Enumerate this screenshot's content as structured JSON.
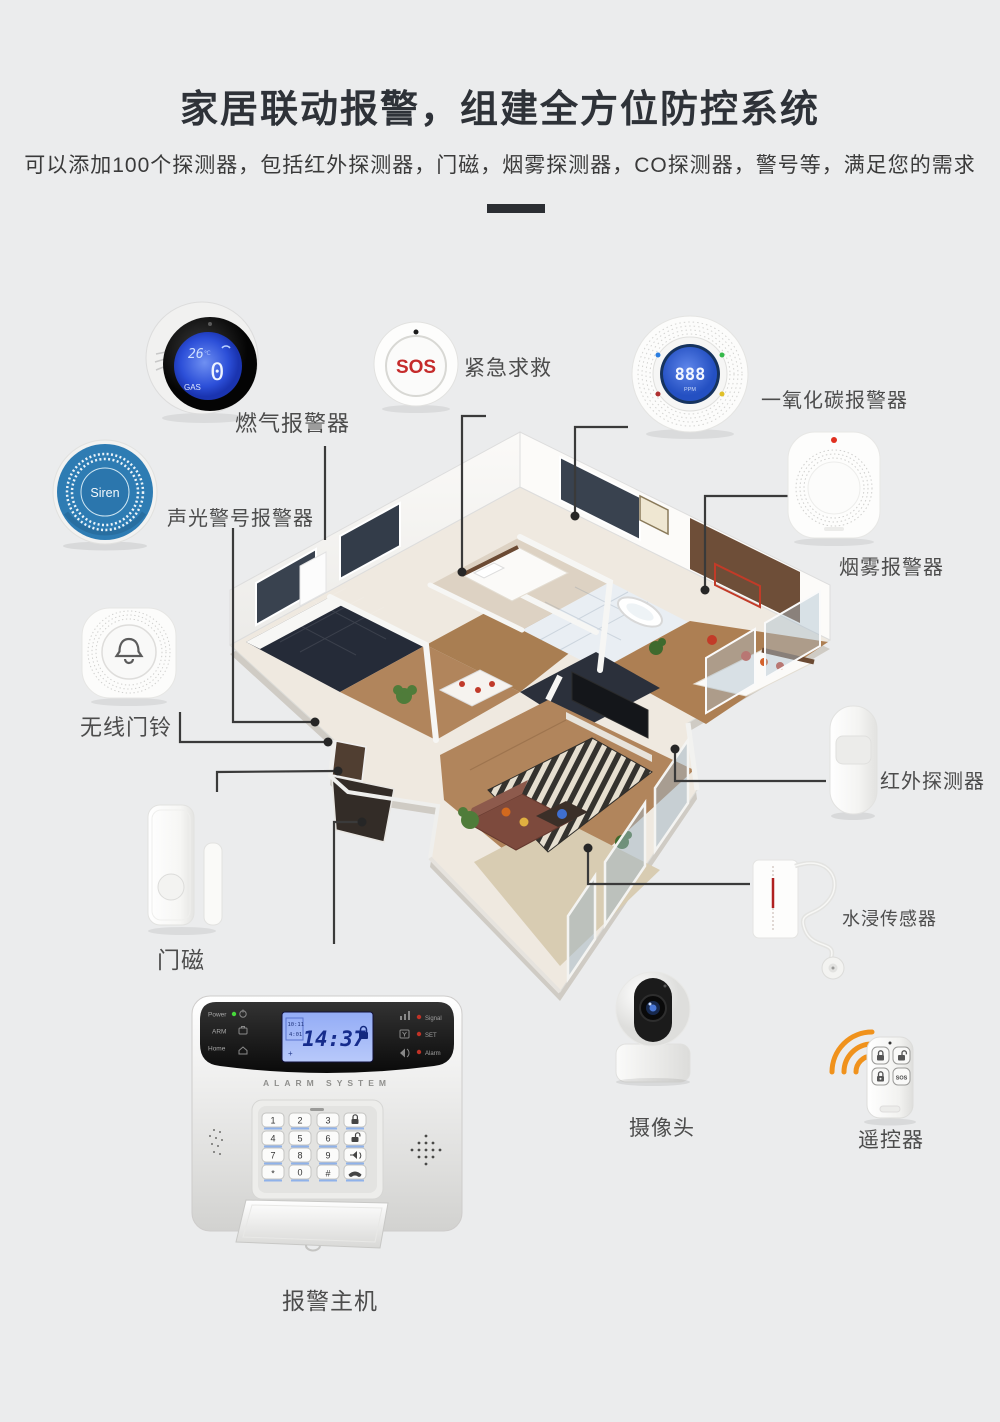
{
  "header": {
    "title": "家居联动报警，组建全方位防控系统",
    "subtitle": "可以添加100个探测器，包括红外探测器，门磁，烟雾探测器，CO探测器，警号等，满足您的需求"
  },
  "devices": {
    "gas_alarm": {
      "label": "燃气报警器",
      "lcd": {
        "temp": "26",
        "temp_unit": "℃",
        "value": "0",
        "gas_text": "GAS"
      }
    },
    "sos_button": {
      "label": "紧急求救",
      "text": "SOS"
    },
    "co_alarm": {
      "label": "一氧化碳报警器",
      "lcd": {
        "value": "888",
        "unit": "PPM"
      }
    },
    "smoke_alarm": {
      "label": "烟雾报警器"
    },
    "siren": {
      "label": "声光警号报警器",
      "text": "Siren"
    },
    "doorbell": {
      "label": "无线门铃"
    },
    "pir_detector": {
      "label": "红外探测器"
    },
    "door_sensor": {
      "label": "门磁"
    },
    "water_sensor": {
      "label": "水浸传感器"
    },
    "camera": {
      "label": "摄像头"
    },
    "remote": {
      "label": "遥控器",
      "sos_key": "SOS"
    },
    "alarm_host": {
      "label": "报警主机",
      "brand": "ALARM SYSTEM",
      "lcd": {
        "time": "14:37",
        "small_top": "10:11",
        "small_bottom": "4:01",
        "plus": "+"
      },
      "status_left": [
        "Power",
        "ARM",
        "Home"
      ],
      "status_right": [
        "Signal",
        "SET",
        "Alarm"
      ],
      "keys": [
        [
          "1",
          "2",
          "3"
        ],
        [
          "4",
          "5",
          "6"
        ],
        [
          "7",
          "8",
          "9"
        ],
        [
          "*",
          "0",
          "#"
        ]
      ]
    }
  },
  "colors": {
    "accent_orange": "#f0921c",
    "siren_blue": "#2e7cb3",
    "sos_red": "#c52b2b",
    "lcd_blue": "#3f62d6",
    "connector_line": "#3a3a3a"
  }
}
